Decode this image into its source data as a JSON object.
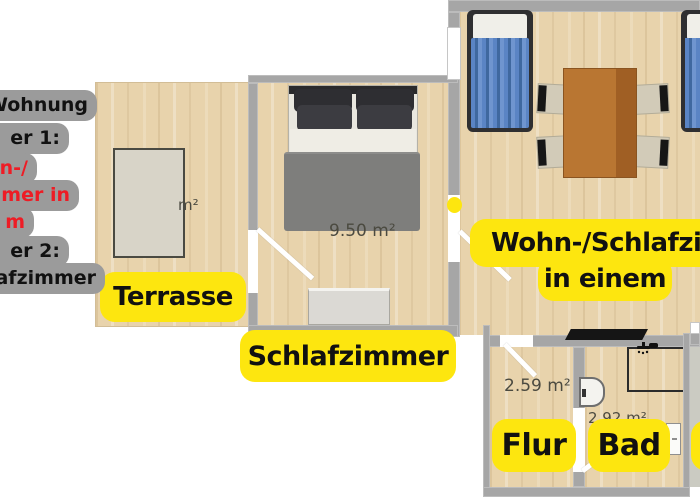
{
  "note_block": {
    "bg": "#9b9b9b",
    "lines": [
      {
        "text": "Wohnung",
        "color": "#111111"
      },
      {
        "text": "er 1:",
        "color": "#111111"
      },
      {
        "text": "n-/",
        "color": "#ee1c25"
      },
      {
        "text": "mer in",
        "color": "#ee1c25"
      },
      {
        "text": "m",
        "color": "#ee1c25"
      },
      {
        "text": "er 2:",
        "color": "#111111"
      },
      {
        "text": "afzimmer",
        "color": "#111111"
      }
    ]
  },
  "rooms": {
    "terrasse": {
      "label": "Terrasse",
      "area_text": "m²"
    },
    "schlafzimmer": {
      "label": "Schlafzimmer",
      "area_text": "9.50 m²"
    },
    "wohn_schlafzimmer": {
      "label_line1": "Wohn-/Schlafzimmer",
      "label_line2": "in einem"
    },
    "flur": {
      "label": "Flur",
      "area_text": "2.59 m²"
    },
    "bad": {
      "label": "Bad",
      "area_text": "2.92 m²"
    }
  },
  "icons": {
    "shower": "shower-head-icon"
  },
  "colors": {
    "label_bg": "#fde60f",
    "wall": "#a6a6a6",
    "wood": "#e8d3ac",
    "note_bg": "#9b9b9b",
    "note_red": "#ee1c25",
    "bed_blue": "#5a84c4",
    "table_brown": "#b97632",
    "blanket_gray": "#7e7e7c"
  }
}
